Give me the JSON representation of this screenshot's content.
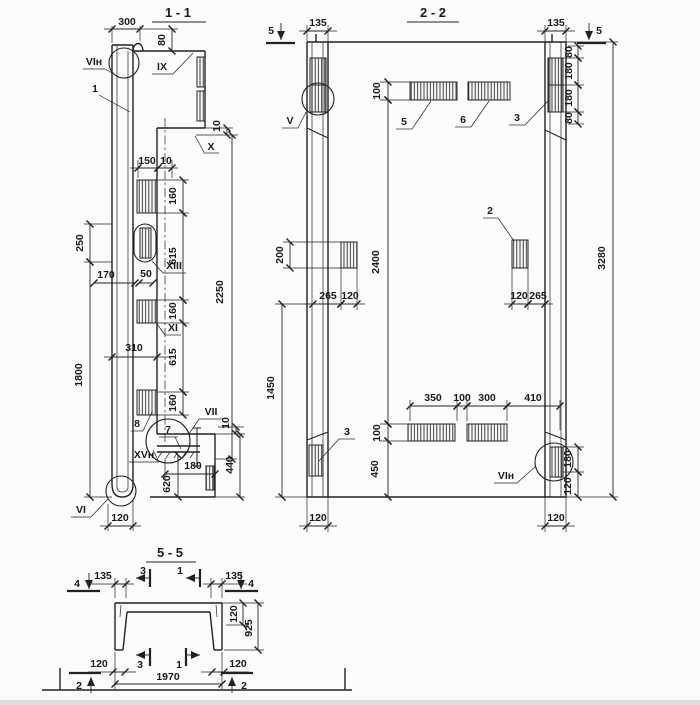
{
  "s11": {
    "title": "1 - 1",
    "labels": {
      "vi_top": "VIн",
      "ix": "IX",
      "x": "X",
      "xiii": "XIII",
      "xi": "XI",
      "vii": "VII",
      "xvn": "XVн",
      "vi_bot": "VI",
      "c1": "1",
      "c7": "7",
      "c8": "8"
    },
    "dims": {
      "d300": "300",
      "d80": "80",
      "d10a": "10",
      "d150": "150",
      "d10b": "10",
      "d160a": "160",
      "d615a": "615",
      "d160b": "160",
      "d615b": "615",
      "d160c": "160",
      "d2250": "2250",
      "d250": "250",
      "d1800": "1800",
      "d170": "170",
      "d50": "50",
      "d310": "310",
      "d10c": "10",
      "d440": "440",
      "d620": "620",
      "d180": "180",
      "d120": "120"
    }
  },
  "s22": {
    "title": "2 - 2",
    "labels": {
      "v": "V",
      "vn": "VIн",
      "c2": "2",
      "c3a": "3",
      "c3b": "3",
      "c5": "5",
      "c6": "6"
    },
    "markers": {
      "m5l": "5",
      "m5r": "5"
    },
    "dims": {
      "d135l": "135",
      "d135r": "135",
      "d80a": "80",
      "d180a": "180",
      "d180b": "180",
      "d80b": "80",
      "d100a": "100",
      "d2400": "2400",
      "d100b": "100",
      "d450": "450",
      "d200": "200",
      "d1450": "1450",
      "d265a": "265",
      "d120a": "120",
      "d120b": "120",
      "d265b": "265",
      "d350": "350",
      "d100c": "100",
      "d300": "300",
      "d410": "410",
      "d180c": "180",
      "d120c": "120",
      "d120l": "120",
      "d120r": "120",
      "d3280": "3280"
    }
  },
  "s55": {
    "title": "5 - 5",
    "markers": {
      "m4l": "4",
      "m4r": "4",
      "m2l": "2",
      "m2r": "2",
      "m3t": "3",
      "m1t": "1",
      "m3b": "3",
      "m1b": "1"
    },
    "dims": {
      "d135l": "135",
      "d135r": "135",
      "d120t": "120",
      "d925": "925",
      "d120l": "120",
      "d120r": "120",
      "d1970": "1970"
    }
  }
}
